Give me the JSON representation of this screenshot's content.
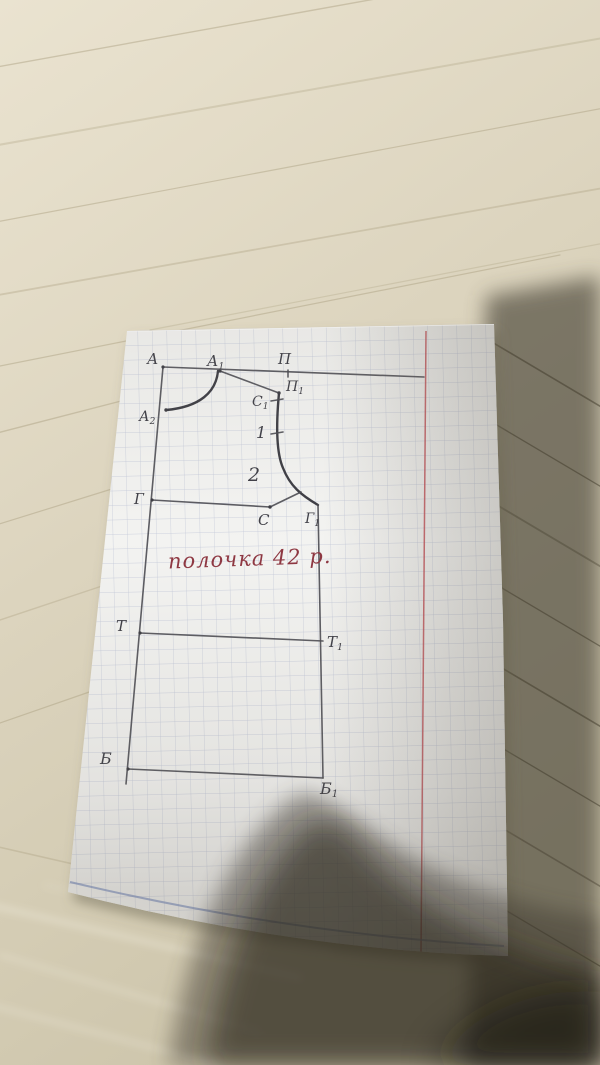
{
  "scene": {
    "description": "Photograph of a hand-drawn sewing pattern draft (bodice front, size 42) on squared notebook paper lying on a light wooden table; a dark phone/hand shadow covers the lower-right corner",
    "colors": {
      "table_light": "#e7e0cc",
      "table_mid": "#d6ceb7",
      "table_shadowed_wood": "#6e6753",
      "deep_shadow": "#2a2721",
      "paper_white": "#f3f3f1",
      "grid_blue": "#97a1c2",
      "red_margin_line": "#c5525a",
      "blue_bottom_line": "#7f91c2",
      "pencil_gray": "#44444b",
      "handwriting_red": "#8e3742"
    }
  },
  "diagram": {
    "type": "sewing-pattern-draft",
    "annotation": "полочка 42 р.",
    "labels": {
      "A": {
        "base": "А",
        "sub": ""
      },
      "A1": {
        "base": "А",
        "sub": "1"
      },
      "A2": {
        "base": "А",
        "sub": "2"
      },
      "P": {
        "base": "П",
        "sub": ""
      },
      "P1": {
        "base": "П",
        "sub": "1"
      },
      "C1": {
        "base": "С",
        "sub": "1"
      },
      "n1": {
        "base": "1",
        "sub": ""
      },
      "n2": {
        "base": "2",
        "sub": ""
      },
      "C": {
        "base": "С",
        "sub": ""
      },
      "G": {
        "base": "Г",
        "sub": ""
      },
      "G1": {
        "base": "Г",
        "sub": "1"
      },
      "T": {
        "base": "Т",
        "sub": ""
      },
      "T1": {
        "base": "Т",
        "sub": "1"
      },
      "B": {
        "base": "Б",
        "sub": ""
      },
      "B1": {
        "base": "Б",
        "sub": "1"
      }
    },
    "points": [
      {
        "id": "A",
        "label": "А",
        "x": 163,
        "y": 367
      },
      {
        "id": "A1",
        "label": "А₁",
        "x": 220,
        "y": 371
      },
      {
        "id": "A2",
        "label": "А₂",
        "x": 166,
        "y": 410
      },
      {
        "id": "P",
        "label": "П",
        "x": 288,
        "y": 373
      },
      {
        "id": "P1",
        "label": "П₁",
        "x": 279,
        "y": 393
      },
      {
        "id": "C1",
        "label": "С₁",
        "x": 277,
        "y": 400
      },
      {
        "id": "1",
        "label": "1",
        "x": 277,
        "y": 433
      },
      {
        "id": "2",
        "label": "2",
        "x": 280,
        "y": 472
      },
      {
        "id": "C",
        "label": "С",
        "x": 270,
        "y": 507
      },
      {
        "id": "G",
        "label": "Г",
        "x": 152,
        "y": 500
      },
      {
        "id": "G1",
        "label": "Г₁",
        "x": 318,
        "y": 506
      },
      {
        "id": "T",
        "label": "Т",
        "x": 140,
        "y": 633
      },
      {
        "id": "T1",
        "label": "Т₁",
        "x": 323,
        "y": 641
      },
      {
        "id": "B",
        "label": "Б",
        "x": 128,
        "y": 769
      },
      {
        "id": "B1",
        "label": "Б₁",
        "x": 323,
        "y": 778
      }
    ],
    "lines": [
      "А–П top shoulder-level line extending to red margin",
      "А–Г–Т–Б center-front vertical line",
      "А₁–П₁ shoulder slope line",
      "А₁–А₂ neckline curve",
      "П₁–1–2–Г₁ armhole curve with С armpit point",
      "Г–С chest line",
      "Т–Т₁ waist line",
      "Б–Б₁ bottom (hip) line",
      "Г₁–Т₁–Б₁ side-seam vertical line"
    ]
  }
}
